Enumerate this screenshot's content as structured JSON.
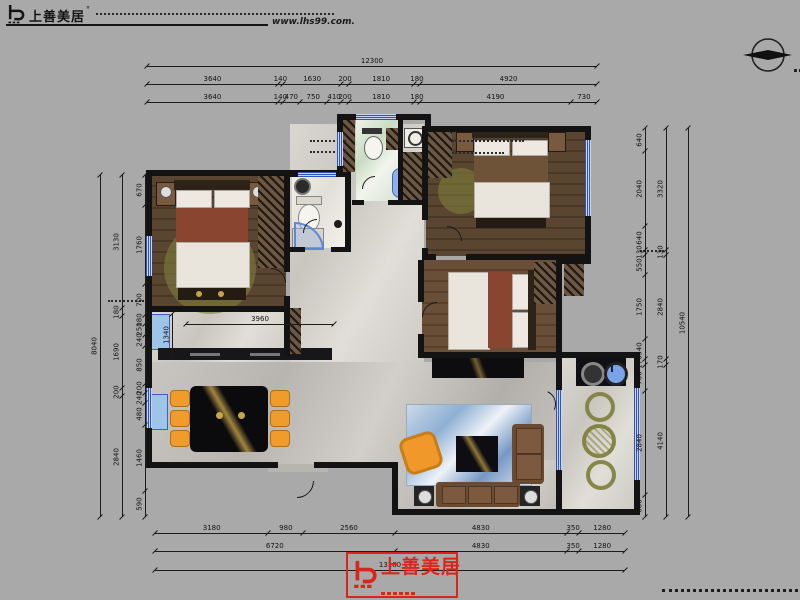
{
  "canvas": {
    "width": 800,
    "height": 600,
    "background": "#a9a9a9"
  },
  "header": {
    "brand": "上善美居",
    "brand_mark": "shangshan-logo-mark",
    "website": "www.lhs99.com."
  },
  "compass": {
    "icon": "north-arrow-icon"
  },
  "footer_logo": {
    "brand": "上善美居",
    "color": "#d9251c"
  },
  "dimensions": {
    "top_total": "12300",
    "top_row2": [
      "3640",
      "140",
      "1630",
      "200",
      "1810",
      "180",
      "4920"
    ],
    "top_row3": [
      "3640",
      "140",
      "470",
      "750",
      "410",
      "200",
      "1810",
      "180",
      "4190",
      "730"
    ],
    "bottom_row1": [
      "3180",
      "980",
      "2560",
      "4830",
      "350",
      "1280"
    ],
    "bottom_row2": [
      "6720",
      "4830",
      "350",
      "1280"
    ],
    "bottom_total": "13180",
    "left_total": "8040",
    "left_middle": [
      "3130",
      "180",
      "1690",
      "200",
      "2840"
    ],
    "left_inner": [
      "670",
      "1760",
      "700",
      "180",
      "250",
      "240",
      "850",
      "200",
      "240",
      "480",
      "1460",
      "590"
    ],
    "right_total": "10540",
    "right_middle": [
      "3320",
      "130",
      "2840",
      "170",
      "4140"
    ],
    "right_inner": [
      "640",
      "2040",
      "640",
      "130",
      "550",
      "1750",
      "540",
      "170",
      "700",
      "2840",
      "600"
    ],
    "hall_width": "3960",
    "hall_depth": "1340"
  },
  "palette": {
    "wall": "#131313",
    "window_blue": "#3d62c4",
    "accent_red": "#d9251c",
    "wood_floor": "#55412f",
    "rug_blue": "#8fb0d4",
    "rug_olive": "#7d7d3a",
    "chair_orange": "#ef9c2c",
    "marble_gray": "#c6c3be"
  }
}
